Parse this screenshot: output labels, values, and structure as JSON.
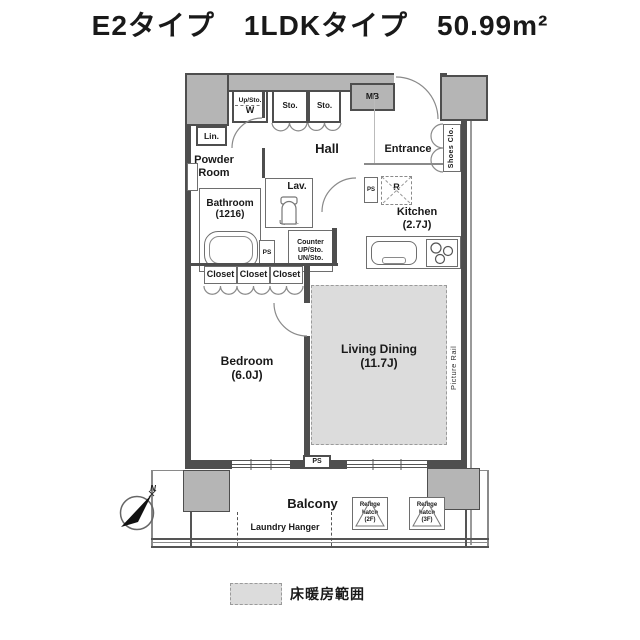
{
  "title": "E2タイプ　1LDKタイプ　50.99m²",
  "legend": {
    "floor_heating_label": "床暖房範囲"
  },
  "compass": {
    "north_label": "N"
  },
  "rooms": {
    "powder_room": "Powder\nRoom",
    "bathroom": "Bathroom\n(1216)",
    "lavatory": "Lav.",
    "hall": "Hall",
    "entrance": "Entrance",
    "shoes_closet": "Shoes Clo.",
    "kitchen": "Kitchen\n(2.7J)",
    "living_dining": "Living Dining\n(11.7J)",
    "bedroom": "Bedroom\n(6.0J)",
    "balcony": "Balcony"
  },
  "fixtures": {
    "upper_storage": "Up/Sto.",
    "washer": "W",
    "storage": [
      "Sto.",
      "Sto."
    ],
    "meter_box": "MB",
    "linen": "Lin.",
    "lav_storage": "Up/Sto.",
    "pipe_space_bath": "PS",
    "pipe_space_kitchen": "PS",
    "pipe_space_balcony": "PS",
    "counter": "Counter\nUP/Sto.\nUN/Sto.",
    "refrigerator": "R",
    "closets": [
      "Closet",
      "Closet",
      "Closet"
    ],
    "picture_rail": "Picture Rail",
    "laundry_hanger": "Laundry Hanger",
    "refuge_hatch_2f": "Refuge\nhatch\n(2F)",
    "refuge_hatch_3f": "Refuge\nhatch\n(3F)"
  },
  "colors": {
    "wall": "#4e4e4e",
    "common_area": "#b5b5b5",
    "floor_heating": "#dcdcdc"
  }
}
